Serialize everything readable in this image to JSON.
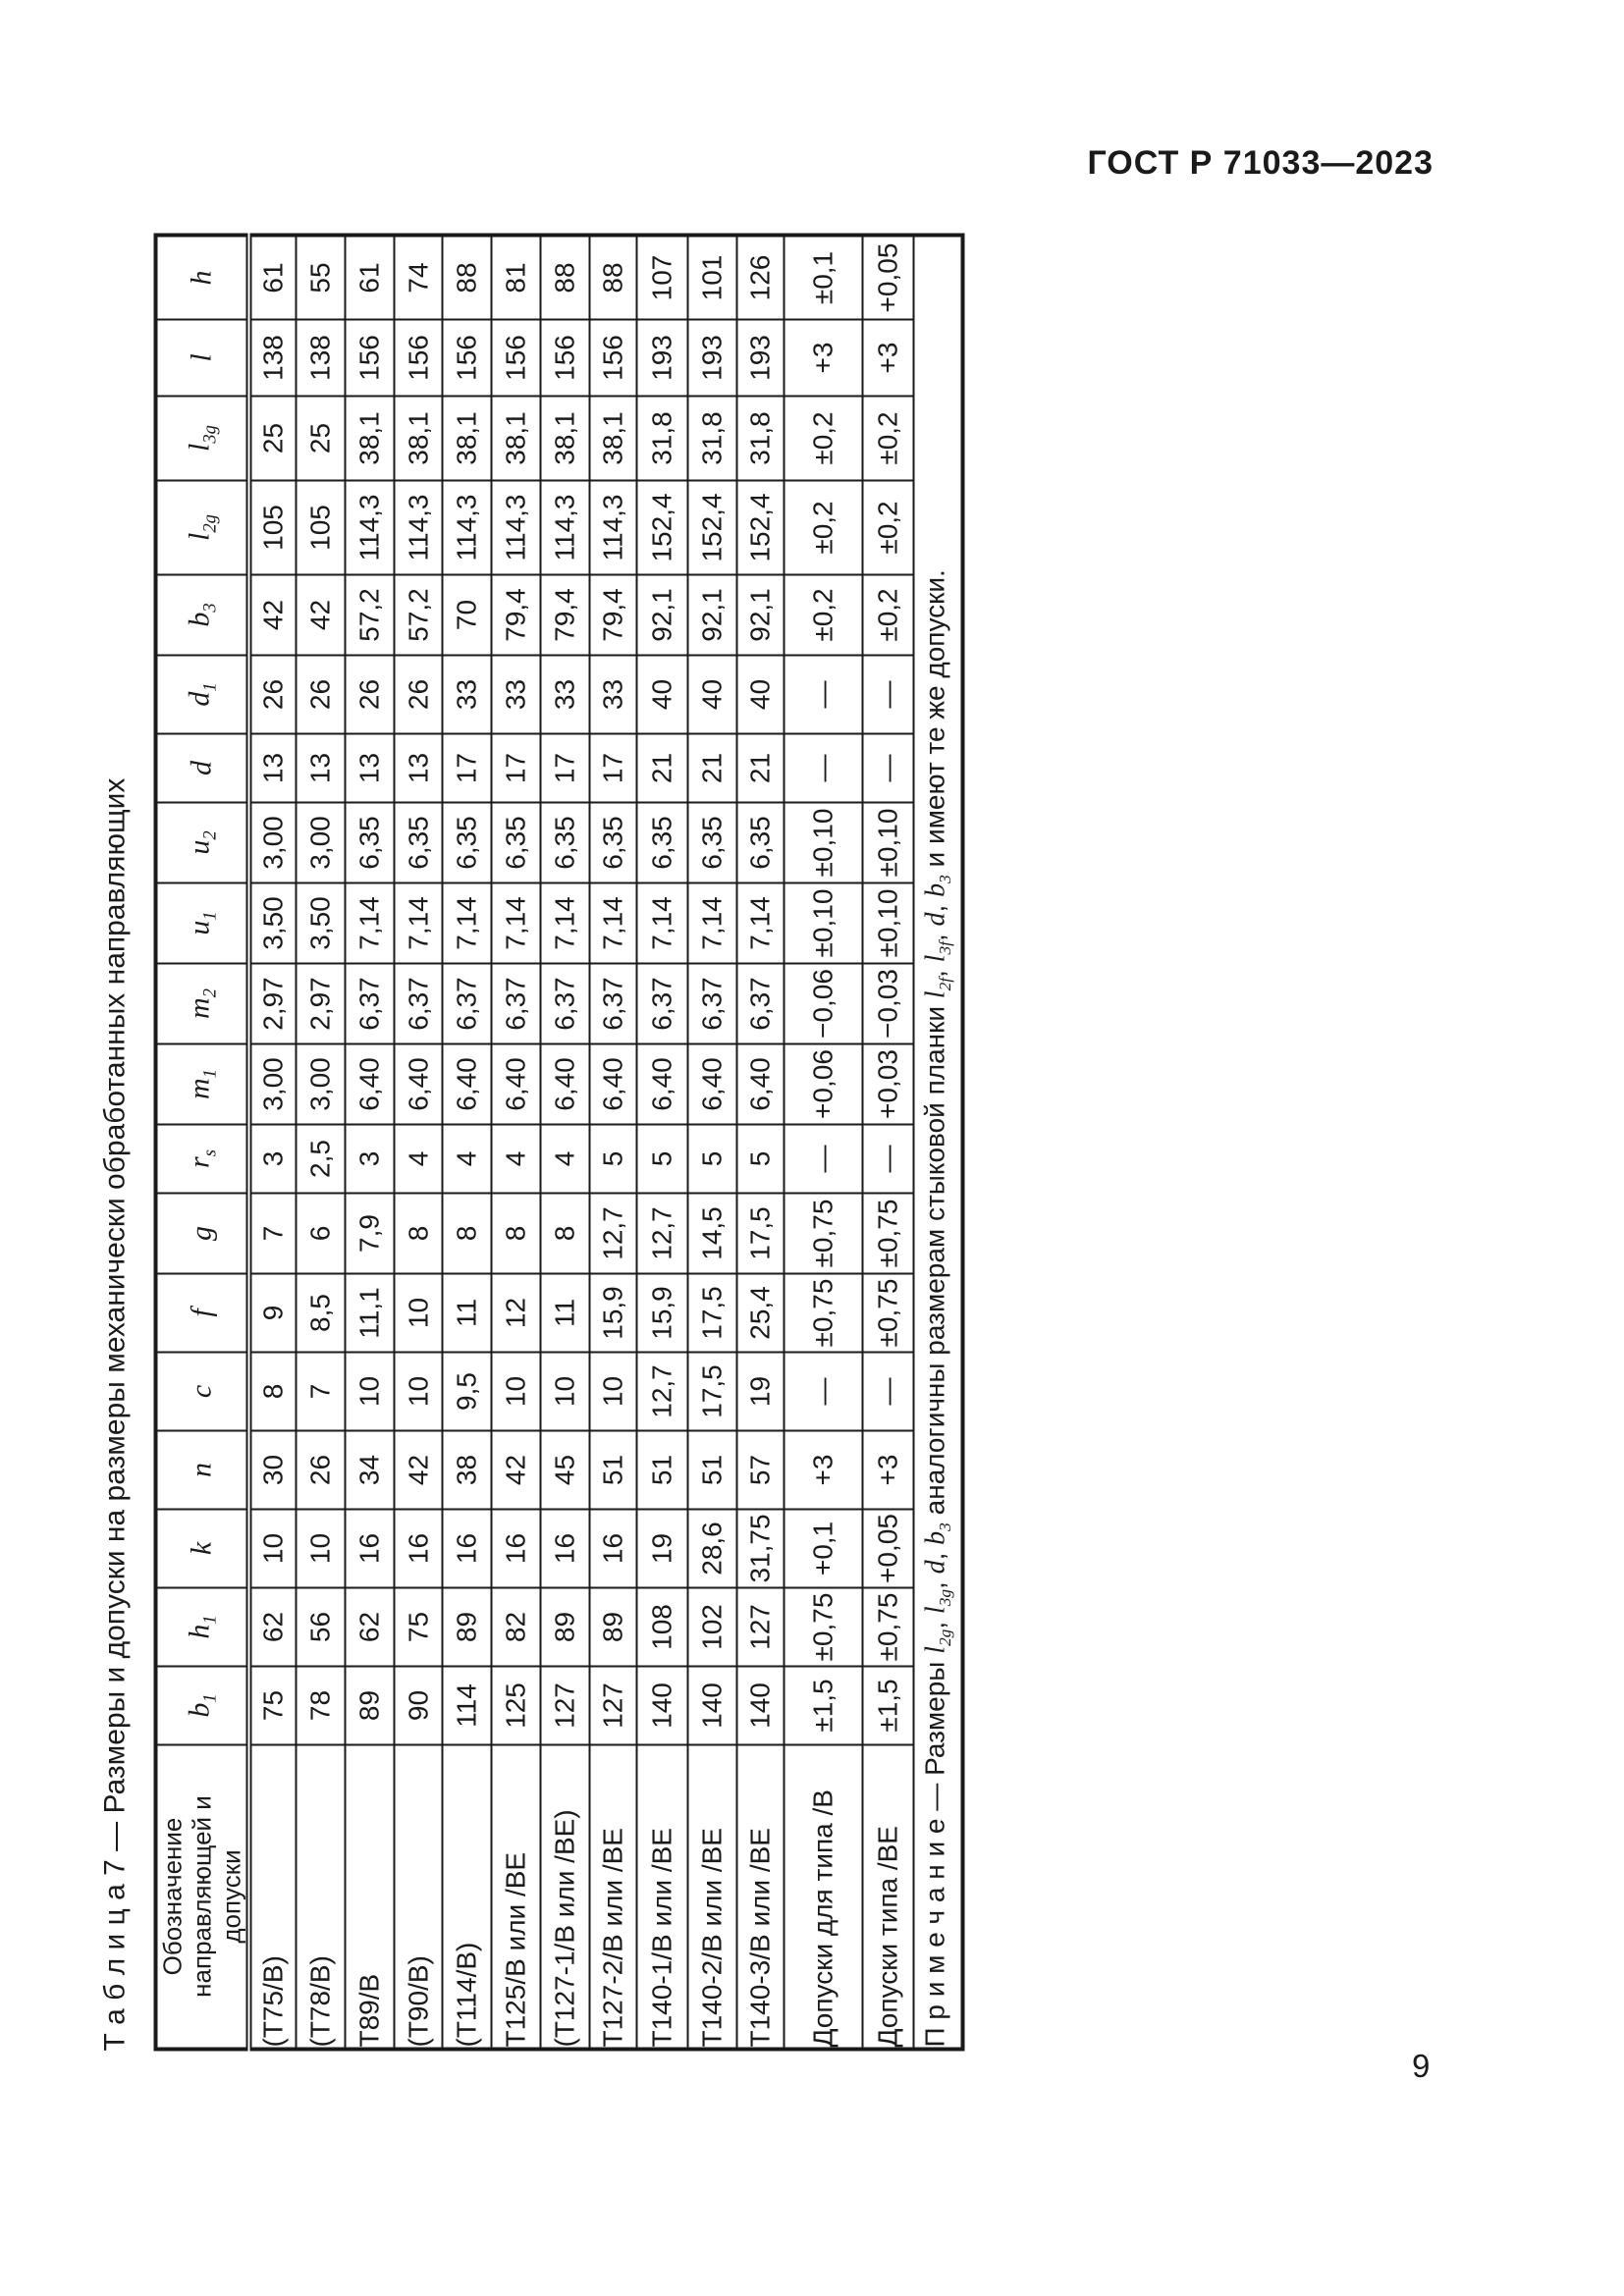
{
  "page": {
    "header": "ГОСТ Р 71033—2023",
    "page_number": "9"
  },
  "table": {
    "title": "Т а б л и ц а  7 — Размеры и допуски на размеры механически обработанных направляющих",
    "columns": [
      "Обозначение направляющей и допуски",
      "*b~1~*",
      "*h~1~*",
      "*k*",
      "*n*",
      "*c*",
      "*f*",
      "*g*",
      "*r~s~*",
      "*m~1~*",
      "*m~2~*",
      "*u~1~*",
      "*u~2~*",
      "*d*",
      "*d~1~*",
      "*b~3~*",
      "*l~2g~*",
      "*l~3g~*",
      "*l*",
      "*h*"
    ],
    "rows": [
      {
        "label": "(Т75/В)",
        "values": [
          "75",
          "62",
          "10",
          "30",
          "8",
          "9",
          "7",
          "3",
          "3,00",
          "2,97",
          "3,50",
          "3,00",
          "13",
          "26",
          "42",
          "105",
          "25",
          "138",
          "61"
        ]
      },
      {
        "label": "(Т78/В)",
        "values": [
          "78",
          "56",
          "10",
          "26",
          "7",
          "8,5",
          "6",
          "2,5",
          "3,00",
          "2,97",
          "3,50",
          "3,00",
          "13",
          "26",
          "42",
          "105",
          "25",
          "138",
          "55"
        ]
      },
      {
        "label": "Т89/В",
        "values": [
          "89",
          "62",
          "16",
          "34",
          "10",
          "11,1",
          "7,9",
          "3",
          "6,40",
          "6,37",
          "7,14",
          "6,35",
          "13",
          "26",
          "57,2",
          "114,3",
          "38,1",
          "156",
          "61"
        ]
      },
      {
        "label": "(Т90/В)",
        "values": [
          "90",
          "75",
          "16",
          "42",
          "10",
          "10",
          "8",
          "4",
          "6,40",
          "6,37",
          "7,14",
          "6,35",
          "13",
          "26",
          "57,2",
          "114,3",
          "38,1",
          "156",
          "74"
        ]
      },
      {
        "label": "(Т114/В)",
        "values": [
          "114",
          "89",
          "16",
          "38",
          "9,5",
          "11",
          "8",
          "4",
          "6,40",
          "6,37",
          "7,14",
          "6,35",
          "17",
          "33",
          "70",
          "114,3",
          "38,1",
          "156",
          "88"
        ]
      },
      {
        "label": "Т125/В или /ВЕ",
        "values": [
          "125",
          "82",
          "16",
          "42",
          "10",
          "12",
          "8",
          "4",
          "6,40",
          "6,37",
          "7,14",
          "6,35",
          "17",
          "33",
          "79,4",
          "114,3",
          "38,1",
          "156",
          "81"
        ]
      },
      {
        "label": "(Т127-1/В или /ВЕ)",
        "values": [
          "127",
          "89",
          "16",
          "45",
          "10",
          "11",
          "8",
          "4",
          "6,40",
          "6,37",
          "7,14",
          "6,35",
          "17",
          "33",
          "79,4",
          "114,3",
          "38,1",
          "156",
          "88"
        ]
      },
      {
        "label": "Т127-2/В или /ВЕ",
        "values": [
          "127",
          "89",
          "16",
          "51",
          "10",
          "15,9",
          "12,7",
          "5",
          "6,40",
          "6,37",
          "7,14",
          "6,35",
          "17",
          "33",
          "79,4",
          "114,3",
          "38,1",
          "156",
          "88"
        ]
      },
      {
        "label": "Т140-1/В или /ВЕ",
        "values": [
          "140",
          "108",
          "19",
          "51",
          "12,7",
          "15,9",
          "12,7",
          "5",
          "6,40",
          "6,37",
          "7,14",
          "6,35",
          "21",
          "40",
          "92,1",
          "152,4",
          "31,8",
          "193",
          "107"
        ]
      },
      {
        "label": "Т140-2/В или /ВЕ",
        "values": [
          "140",
          "102",
          "28,6",
          "51",
          "17,5",
          "17,5",
          "14,5",
          "5",
          "6,40",
          "6,37",
          "7,14",
          "6,35",
          "21",
          "40",
          "92,1",
          "152,4",
          "31,8",
          "193",
          "101"
        ]
      },
      {
        "label": "Т140-3/В или /ВЕ",
        "values": [
          "140",
          "127",
          "31,75",
          "57",
          "19",
          "25,4",
          "17,5",
          "5",
          "6,40",
          "6,37",
          "7,14",
          "6,35",
          "21",
          "40",
          "92,1",
          "152,4",
          "31,8",
          "193",
          "126"
        ]
      },
      {
        "label": "Допуски для типа /В",
        "values": [
          "±1,5",
          "±0,75",
          "+0,1",
          "+3",
          "—",
          "±0,75",
          "±0,75",
          "—",
          "+0,06",
          "−0,06",
          "±0,10",
          "±0,10",
          "—",
          "—",
          "±0,2",
          "±0,2",
          "±0,2",
          "+3",
          "±0,1"
        ]
      },
      {
        "label": "Допуски типа /ВЕ",
        "values": [
          "±1,5",
          "±0,75",
          "+0,05",
          "+3",
          "—",
          "±0,75",
          "±0,75",
          "—",
          "+0,03",
          "−0,03",
          "±0,10",
          "±0,10",
          "—",
          "—",
          "±0,2",
          "±0,2",
          "±0,2",
          "+3",
          "+0,05"
        ]
      }
    ],
    "note": "П р и м е ч а н и е  — Размеры *l~2g~*, *l~3g~*, *d*, *b~3~* аналогичны размерам стыковой планки *l~2f~*, *l~3f~*, *d*, *b~3~* и имеют те же допуски.",
    "colors": {
      "text": "#1a1a1a",
      "border": "#1a1a1a",
      "background": "#ffffff"
    }
  }
}
